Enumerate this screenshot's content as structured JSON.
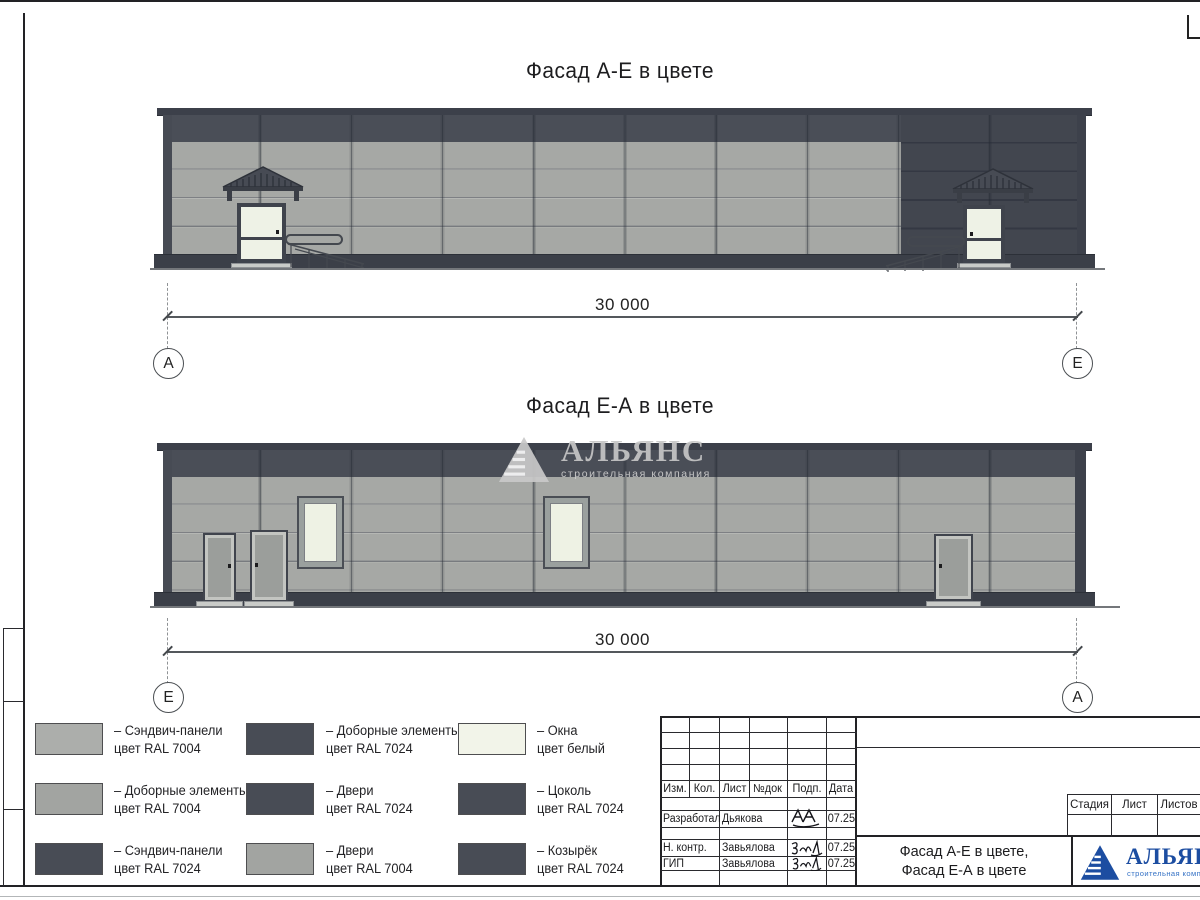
{
  "titles": {
    "facade_top": "Фасад А-Е в цвете",
    "facade_bottom": "Фасад Е-А в цвете"
  },
  "dimensions": {
    "top": {
      "value": "30 000",
      "axis_left": "А",
      "axis_right": "Е"
    },
    "bottom": {
      "value": "30 000",
      "axis_left": "Е",
      "axis_right": "А"
    }
  },
  "watermark": {
    "name": "АЛЬЯНС",
    "subtitle": "строительная компания"
  },
  "legend": {
    "columns": [
      {
        "items": [
          {
            "swatch": "ral7004_light",
            "line1": "– Сэндвич-панели",
            "line2": "цвет RAL 7004"
          },
          {
            "swatch": "ral7004",
            "line1": "– Доборные элементы",
            "line2": "цвет RAL 7004"
          },
          {
            "swatch": "ral7024",
            "line1": "– Сэндвич-панели",
            "line2": "цвет RAL 7024"
          }
        ]
      },
      {
        "items": [
          {
            "swatch": "ral7024",
            "line1": "– Доборные элементы",
            "line2": "цвет RAL 7024"
          },
          {
            "swatch": "ral7024",
            "line1": "– Двери",
            "line2": "цвет RAL 7024"
          },
          {
            "swatch": "ral7004",
            "line1": "– Двери",
            "line2": "цвет RAL 7004"
          }
        ]
      },
      {
        "items": [
          {
            "swatch": "white",
            "line1": "– Окна",
            "line2": "цвет белый"
          },
          {
            "swatch": "ral7024",
            "line1": "– Цоколь",
            "line2": "цвет RAL 7024"
          },
          {
            "swatch": "ral7024",
            "line1": "– Козырёк",
            "line2": "цвет RAL 7024"
          }
        ]
      }
    ]
  },
  "titleblock": {
    "change_header": {
      "izm": "Изм.",
      "kol": "Кол.",
      "list": "Лист",
      "ndok": "№док",
      "podp": "Подп.",
      "data": "Дата"
    },
    "sign_rows": [
      {
        "role": "Разработал",
        "name": "Дьякова",
        "date": "07.25"
      },
      {
        "role": "Н. контр.",
        "name": "Завьялова",
        "date": "07.25"
      },
      {
        "role": "ГИП",
        "name": "Завьялова",
        "date": "07.25"
      }
    ],
    "stage_header": {
      "stadia": "Стадия",
      "list": "Лист",
      "listov": "Листов"
    },
    "doc_title": {
      "line1": "Фасад А-Е в цвете,",
      "line2": "Фасад Е-А в цвете"
    },
    "logo": {
      "name": "АЛЬЯНС",
      "subtitle": "строительная компания"
    }
  },
  "colors": {
    "ral7004": "#a5a7a4",
    "ral7004_light": "#acaeab",
    "ral7024": "#474b54",
    "window_white": "#f0f3e9",
    "logo_blue": "#1c4da1",
    "watermark_gray": "#c7c7c7"
  }
}
